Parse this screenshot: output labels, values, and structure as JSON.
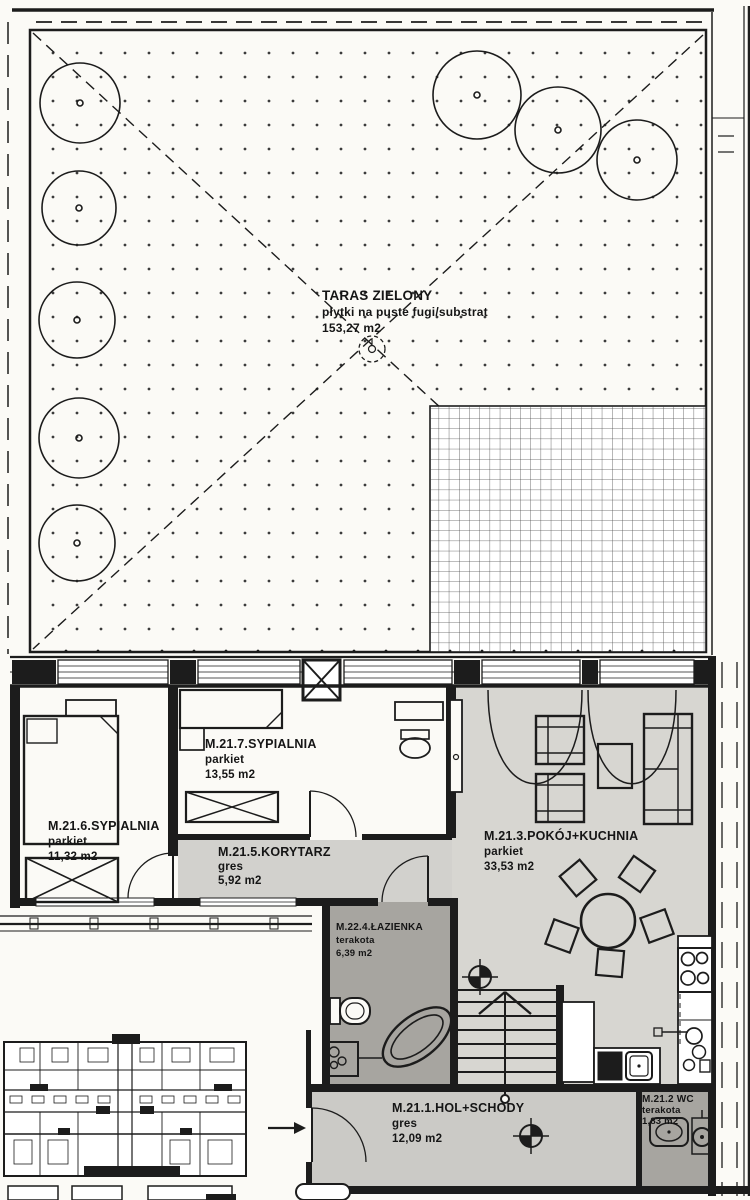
{
  "terrace": {
    "id": "TARAS ZIELONY",
    "finish": "płytki na puste fugi/substrat",
    "area": "153,27 m2"
  },
  "rooms": {
    "sypialnia_6": {
      "id": "M.21.6.SYPIALNIA",
      "finish": "parkiet",
      "area": "11,32 m2"
    },
    "sypialnia_7": {
      "id": "M.21.7.SYPIALNIA",
      "finish": "parkiet",
      "area": "13,55 m2"
    },
    "korytarz": {
      "id": "M.21.5.KORYTARZ",
      "finish": "gres",
      "area": "5,92 m2"
    },
    "pokoj_kuchnia": {
      "id": "M.21.3.POKÓJ+KUCHNIA",
      "finish": "parkiet",
      "area": "33,53 m2"
    },
    "lazienka": {
      "id": "M.22.4.ŁAZIENKA",
      "finish": "terakota",
      "area": "6,39 m2"
    },
    "hol": {
      "id": "M.21.1.HOL+SCHODY",
      "finish": "gres",
      "area": "12,09 m2"
    },
    "wc": {
      "id": "M.21.2 WC",
      "finish": "terakota",
      "area": "1,83 m2"
    }
  },
  "colors": {
    "paper": "#fbfaf6",
    "ink": "#1c1c1c",
    "room_light": "#d7d6d1",
    "room_mid": "#cbcac6",
    "room_dark": "#a7a5a0"
  }
}
